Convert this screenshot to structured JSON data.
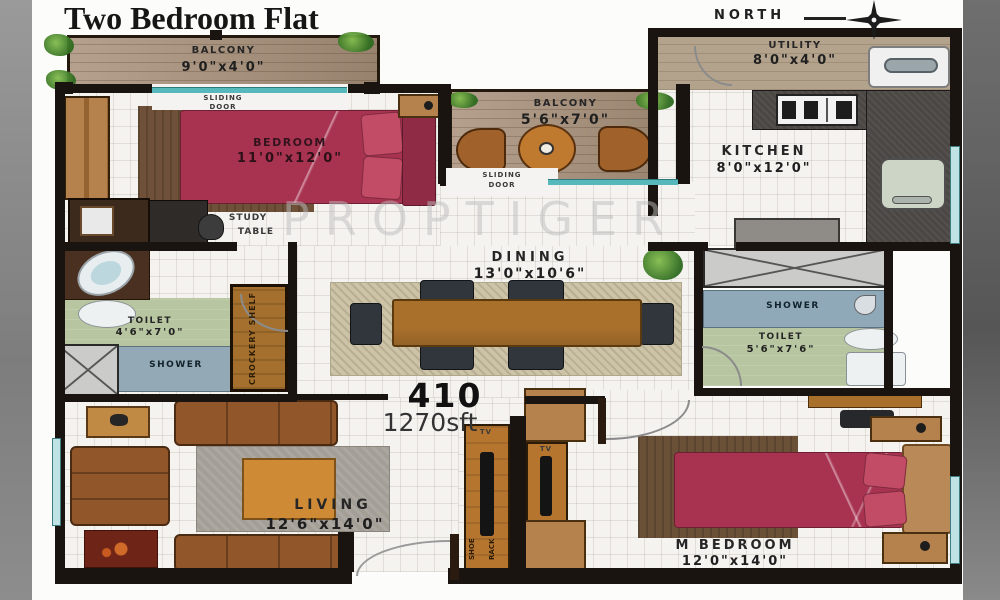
{
  "header": {
    "title": "Two Bedroom Flat",
    "north_label": "NORTH"
  },
  "unit": {
    "number": "410",
    "area": "1270sft"
  },
  "watermark": "PROPTIGER",
  "rooms": {
    "balcony_top": {
      "name": "BALCONY",
      "dims": "9'0\"x4'0\""
    },
    "bedroom": {
      "name": "BEDROOM",
      "dims": "11'0\"x12'0\""
    },
    "balcony_mid": {
      "name": "BALCONY",
      "dims": "5'6\"x7'0\""
    },
    "utility": {
      "name": "UTILITY",
      "dims": "8'0\"x4'0\""
    },
    "kitchen": {
      "name": "KITCHEN",
      "dims": "8'0\"x12'0\""
    },
    "dining": {
      "name": "DINING",
      "dims": "13'0\"x10'6\""
    },
    "toilet_left": {
      "name": "TOILET",
      "dims": "4'6\"x7'0\"",
      "shower": "SHOWER"
    },
    "toilet_right": {
      "name": "TOILET",
      "dims": "5'6\"x7'6\"",
      "shower": "SHOWER"
    },
    "living": {
      "name": "LIVING",
      "dims": "12'6\"x14'0\""
    },
    "m_bedroom": {
      "name": "M BEDROOM",
      "dims": "12'0\"x14'0\""
    }
  },
  "annotations": {
    "sliding_door_word1": "SLIDING",
    "sliding_door_word2": "DOOR",
    "study_word1": "STUDY",
    "study_word2": "TABLE",
    "crockery_shelf": "CROCKERY SHELF",
    "tv": "TV",
    "shoe_word1": "SHOE",
    "shoe_word2": "RACK"
  },
  "colors": {
    "wall": "#19140f",
    "sliding_door_teal": "#56b8ba",
    "bed_maroon": "#a83350",
    "wood_furniture": "#b5824d",
    "balcony_floor": "#a8917a",
    "toilet_green": "#b7c5a0",
    "shower_blue": "#93aab6",
    "kitchen_counter": "#4b4744"
  }
}
